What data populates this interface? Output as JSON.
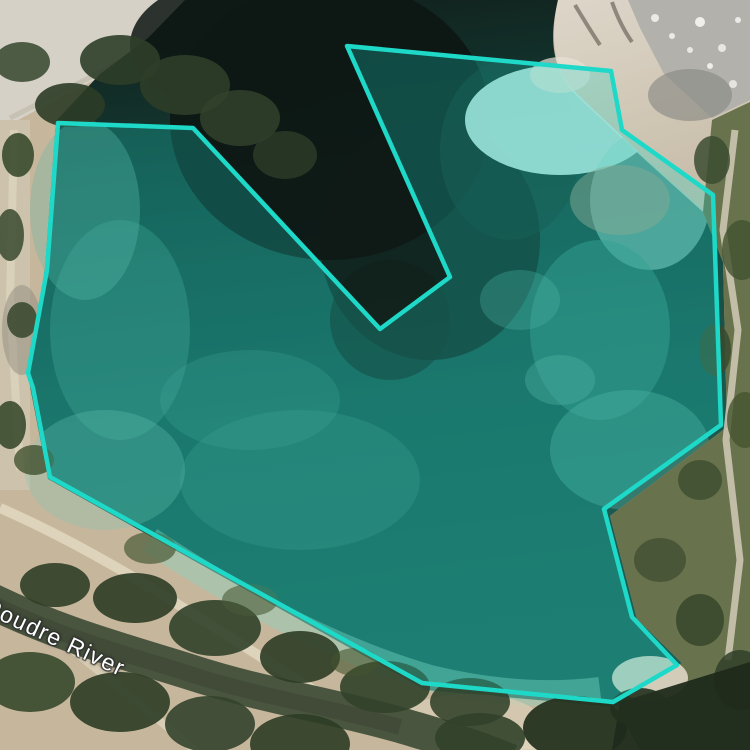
{
  "map": {
    "view_type": "satellite",
    "labels": [
      {
        "id": "river-label",
        "text": "Poudre River",
        "color": "#ffffff",
        "rotation_deg": 25
      }
    ],
    "annotation": {
      "type": "polygon",
      "stroke_color": "#1ed9c8",
      "fill_color": "rgba(31,216,201,0.27)",
      "stroke_width": 4.5,
      "points": [
        [
          58,
          123
        ],
        [
          193,
          128
        ],
        [
          380,
          329
        ],
        [
          450,
          277
        ],
        [
          347,
          46
        ],
        [
          611,
          71
        ],
        [
          622,
          130
        ],
        [
          713,
          195
        ],
        [
          721,
          425
        ],
        [
          604,
          509
        ],
        [
          632,
          617
        ],
        [
          677,
          665
        ],
        [
          613,
          702
        ],
        [
          422,
          683
        ],
        [
          50,
          477
        ],
        [
          33,
          388
        ],
        [
          28,
          373
        ],
        [
          47,
          270
        ]
      ]
    }
  }
}
